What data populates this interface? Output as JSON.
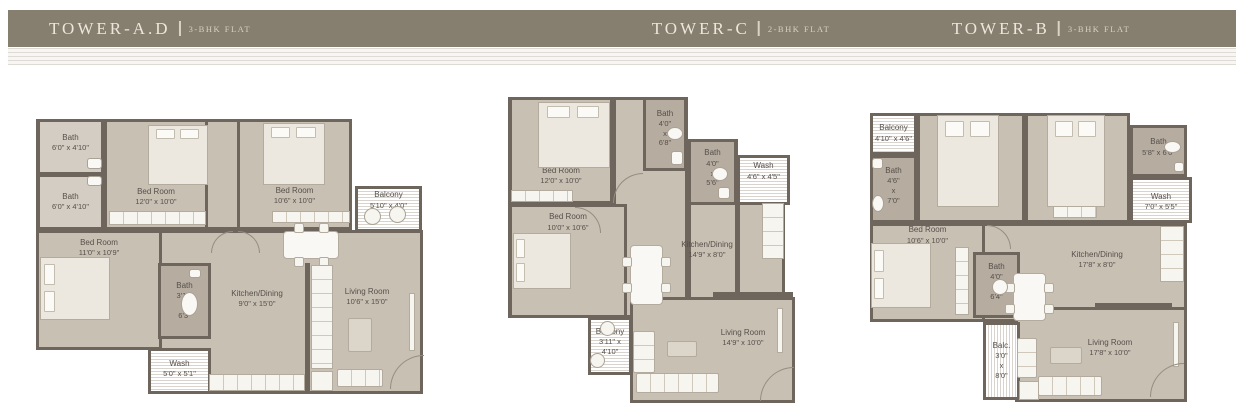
{
  "colors": {
    "wall": "#6E665D",
    "floor": "#C9C0B4",
    "bath": "#B7ACA0",
    "ink": "#55504A",
    "hatchline": "#D8D4CD",
    "bar": "#867E6F",
    "bartext": "#ECE7DA"
  },
  "header": {
    "towers": [
      {
        "name": "TOWER-A.D",
        "type": "3-BHK FLAT"
      },
      {
        "name": "TOWER-C",
        "type": "2-BHK FLAT"
      },
      {
        "name": "TOWER-B",
        "type": "3-BHK FLAT"
      }
    ]
  },
  "plans": [
    {
      "id": "tower-ad",
      "x": 35,
      "y": 112,
      "w": 395,
      "h": 286,
      "bases": [
        {
          "x": 1,
          "y": 7,
          "w": 316,
          "h": 111
        },
        {
          "x": 1,
          "y": 118,
          "w": 126,
          "h": 120
        },
        {
          "x": 113,
          "y": 118,
          "w": 275,
          "h": 164
        }
      ],
      "rooms": [
        {
          "id": "bath-1",
          "t": "bath",
          "x": 2,
          "y": 7,
          "w": 67,
          "h": 56,
          "fc": "#D4CDC3",
          "label": [
            "Bath",
            "6'0\" x 4'10\""
          ],
          "ly": 42
        },
        {
          "id": "bath-2",
          "t": "bath",
          "x": 2,
          "y": 62,
          "w": 67,
          "h": 56,
          "fc": "#D4CDC3",
          "label": [
            "Bath",
            "6'0\" x 4'10\""
          ],
          "ly": 50
        },
        {
          "id": "bedroom-1",
          "t": "room",
          "x": 69,
          "y": 7,
          "w": 104,
          "h": 111,
          "label": [
            "Bed Room",
            "12'0\" x 10'0\""
          ],
          "ly": 71
        },
        {
          "id": "bedroom-2",
          "t": "room",
          "x": 202,
          "y": 7,
          "w": 115,
          "h": 111,
          "label": [
            "Bed Room",
            "10'6\" x 10'0\""
          ],
          "ly": 70
        },
        {
          "id": "balcony",
          "t": "hatch",
          "x": 320,
          "y": 74,
          "w": 67,
          "h": 46,
          "label": [
            "Balcony",
            "5'10\" x 4'0\""
          ],
          "ly": 28
        },
        {
          "id": "bedroom-3",
          "t": "room",
          "x": 1,
          "y": 118,
          "w": 126,
          "h": 120,
          "label": [
            "Bed Room",
            "11'0\" x 10'9\""
          ],
          "ly": 13
        },
        {
          "id": "bath-3",
          "t": "bath",
          "x": 123,
          "y": 151,
          "w": 53,
          "h": 76,
          "label": [
            "Bath",
            "3'11\"",
            "x",
            "6'3\""
          ],
          "ly": 50
        },
        {
          "id": "wash",
          "t": "hatch",
          "x": 113,
          "y": 236,
          "w": 63,
          "h": 46,
          "label": [
            "Wash",
            "5'0\" x 5'1\""
          ],
          "ly": 45
        },
        {
          "id": "kitchen-dining",
          "t": "label",
          "x": 182,
          "y": 170,
          "w": 80,
          "h": 34,
          "label": [
            "Kitchen/Dining",
            "9'0\" x 15'0\""
          ],
          "ly": 50
        },
        {
          "id": "living-room",
          "t": "label",
          "x": 297,
          "y": 170,
          "w": 70,
          "h": 30,
          "label": [
            "Living Room",
            "10'6\" x 15'0\""
          ],
          "ly": 50
        }
      ],
      "furniture": [
        {
          "t": "wall",
          "n": "partition-wall",
          "x": 270,
          "y": 151,
          "w": 5,
          "h": 131
        },
        {
          "t": "bed",
          "n": "bed",
          "x": 113,
          "y": 13,
          "w": 60,
          "h": 60,
          "dir": "n"
        },
        {
          "t": "bed",
          "n": "bed",
          "x": 228,
          "y": 11,
          "w": 62,
          "h": 62,
          "dir": "n"
        },
        {
          "t": "bed",
          "n": "bed",
          "x": 5,
          "y": 145,
          "w": 70,
          "h": 63,
          "dir": "w"
        },
        {
          "t": "rect",
          "n": "wardrobe",
          "x": 74,
          "y": 99,
          "w": 97,
          "h": 14,
          "lines": "v"
        },
        {
          "t": "rect",
          "n": "wardrobe",
          "x": 237,
          "y": 99,
          "w": 78,
          "h": 12,
          "lines": "v"
        },
        {
          "t": "circle",
          "n": "balcony-chair",
          "x": 329,
          "y": 96,
          "w": 17,
          "h": 17
        },
        {
          "t": "circle",
          "n": "balcony-chair",
          "x": 354,
          "y": 94,
          "w": 17,
          "h": 17
        },
        {
          "t": "table",
          "n": "dining-table",
          "x": 248,
          "y": 119,
          "w": 56,
          "h": 28
        },
        {
          "t": "rect",
          "n": "kitchen-counter",
          "x": 174,
          "y": 262,
          "w": 96,
          "h": 17,
          "lines": "v"
        },
        {
          "t": "rect",
          "n": "kitchen-counter",
          "x": 276,
          "y": 153,
          "w": 22,
          "h": 104,
          "lines": "h"
        },
        {
          "t": "rect",
          "n": "sink-unit",
          "x": 276,
          "y": 259,
          "w": 22,
          "h": 20
        },
        {
          "t": "sofa",
          "n": "sofa",
          "x": 302,
          "y": 257,
          "w": 46,
          "h": 18,
          "lines": "v"
        },
        {
          "t": "rug",
          "n": "rug",
          "x": 313,
          "y": 206,
          "w": 24,
          "h": 34
        },
        {
          "t": "rect",
          "n": "tv-unit",
          "x": 374,
          "y": 181,
          "w": 6,
          "h": 58
        },
        {
          "t": "sink",
          "n": "wash-basin",
          "x": 52,
          "y": 46,
          "w": 15,
          "h": 11
        },
        {
          "t": "sink",
          "n": "wash-basin",
          "x": 52,
          "y": 64,
          "w": 15,
          "h": 10
        },
        {
          "t": "wc",
          "n": "toilet",
          "x": 146,
          "y": 180,
          "w": 17,
          "h": 24
        },
        {
          "t": "sink",
          "n": "wash-basin",
          "x": 154,
          "y": 157,
          "w": 12,
          "h": 9
        },
        {
          "t": "arc",
          "n": "door-arc",
          "x": 355,
          "y": 243,
          "w": 34,
          "h": 34,
          "q": "tl"
        },
        {
          "t": "arc",
          "n": "door-arc",
          "x": 176,
          "y": 119,
          "w": 22,
          "h": 22,
          "q": "tl"
        },
        {
          "t": "arc",
          "n": "door-arc",
          "x": 203,
          "y": 119,
          "w": 22,
          "h": 22,
          "q": "tr"
        }
      ]
    },
    {
      "id": "tower-c",
      "x": 505,
      "y": 95,
      "w": 298,
      "h": 310,
      "bases": [
        {
          "x": 3,
          "y": 2,
          "w": 120,
          "h": 221
        },
        {
          "x": 108,
          "y": 2,
          "w": 75,
          "h": 221
        },
        {
          "x": 183,
          "y": 44,
          "w": 50,
          "h": 179
        },
        {
          "x": 232,
          "y": 60,
          "w": 48,
          "h": 163
        },
        {
          "x": 125,
          "y": 202,
          "w": 165,
          "h": 106
        }
      ],
      "rooms": [
        {
          "id": "bedroom-1",
          "t": "room",
          "x": 4,
          "y": 2,
          "w": 104,
          "h": 107,
          "label": [
            "Bed Room",
            "12'0\" x 10'0\""
          ],
          "ly": 75
        },
        {
          "id": "bath-1",
          "t": "bath",
          "x": 138,
          "y": 2,
          "w": 44,
          "h": 74,
          "label": [
            "Bath",
            "4'0\"",
            "x",
            "6'8\""
          ],
          "ly": 42
        },
        {
          "id": "bath-2",
          "t": "bath",
          "x": 183,
          "y": 44,
          "w": 49,
          "h": 66,
          "label": [
            "Bath",
            "4'0\"",
            "x",
            "5'6\""
          ],
          "ly": 44
        },
        {
          "id": "wash",
          "t": "hatch",
          "x": 232,
          "y": 60,
          "w": 53,
          "h": 50,
          "label": [
            "Wash",
            "4'6\" x 4'5\""
          ],
          "ly": 30
        },
        {
          "id": "bedroom-2",
          "t": "room",
          "x": 4,
          "y": 109,
          "w": 118,
          "h": 114,
          "label": [
            "Bed Room",
            "10'0\" x 10'6\""
          ],
          "ly": 14
        },
        {
          "id": "kitchen-dining",
          "t": "label",
          "x": 162,
          "y": 140,
          "w": 80,
          "h": 30,
          "label": [
            "Kitchen/Dining",
            "14'9\" x 8'0\""
          ],
          "ly": 50
        },
        {
          "id": "balcony",
          "t": "hatch",
          "x": 83,
          "y": 222,
          "w": 44,
          "h": 58,
          "label": [
            "Balcony",
            "3'11\" x",
            "4'10\""
          ],
          "ly": 42
        },
        {
          "id": "living-room",
          "t": "label",
          "x": 203,
          "y": 228,
          "w": 70,
          "h": 30,
          "label": [
            "Living Room",
            "14'9\" x 10'0\""
          ],
          "ly": 50
        }
      ],
      "furniture": [
        {
          "t": "wall",
          "n": "partition-wall",
          "x": 208,
          "y": 197,
          "w": 80,
          "h": 6
        },
        {
          "t": "bed",
          "n": "bed",
          "x": 33,
          "y": 7,
          "w": 72,
          "h": 66,
          "dir": "n"
        },
        {
          "t": "rect",
          "n": "wardrobe",
          "x": 6,
          "y": 95,
          "w": 62,
          "h": 12,
          "lines": "v"
        },
        {
          "t": "bed",
          "n": "bed",
          "x": 8,
          "y": 138,
          "w": 58,
          "h": 56,
          "dir": "w"
        },
        {
          "t": "table",
          "n": "dining-table",
          "x": 125,
          "y": 150,
          "w": 33,
          "h": 60
        },
        {
          "t": "rect",
          "n": "kitchen-counter",
          "x": 257,
          "y": 108,
          "w": 22,
          "h": 56,
          "lines": "h"
        },
        {
          "t": "circle",
          "n": "balcony-chair",
          "x": 95,
          "y": 226,
          "w": 15,
          "h": 15
        },
        {
          "t": "circle",
          "n": "balcony-chair",
          "x": 85,
          "y": 258,
          "w": 15,
          "h": 15
        },
        {
          "t": "sofa",
          "n": "sofa",
          "x": 131,
          "y": 278,
          "w": 83,
          "h": 20,
          "lines": "v"
        },
        {
          "t": "sofa",
          "n": "armchair",
          "x": 128,
          "y": 236,
          "w": 22,
          "h": 42,
          "lines": "h"
        },
        {
          "t": "rug",
          "n": "rug",
          "x": 162,
          "y": 246,
          "w": 30,
          "h": 16
        },
        {
          "t": "rect",
          "n": "tv-unit",
          "x": 272,
          "y": 213,
          "w": 6,
          "h": 45
        },
        {
          "t": "wc",
          "n": "toilet",
          "x": 162,
          "y": 32,
          "w": 16,
          "h": 13
        },
        {
          "t": "sink",
          "n": "wash-basin",
          "x": 166,
          "y": 56,
          "w": 12,
          "h": 14
        },
        {
          "t": "wc",
          "n": "toilet",
          "x": 207,
          "y": 72,
          "w": 16,
          "h": 14
        },
        {
          "t": "sink",
          "n": "wash-basin",
          "x": 213,
          "y": 92,
          "w": 12,
          "h": 12
        },
        {
          "t": "arc",
          "n": "door-arc",
          "x": 108,
          "y": 78,
          "w": 30,
          "h": 30,
          "q": "tl"
        },
        {
          "t": "arc",
          "n": "door-arc",
          "x": 255,
          "y": 272,
          "w": 34,
          "h": 34,
          "q": "tl"
        },
        {
          "t": "arc",
          "n": "door-arc",
          "x": 70,
          "y": 112,
          "w": 26,
          "h": 26,
          "q": "tr"
        }
      ]
    },
    {
      "id": "tower-b",
      "x": 870,
      "y": 105,
      "w": 332,
      "h": 300,
      "bases": [
        {
          "x": 0,
          "y": 8,
          "w": 260,
          "h": 110
        },
        {
          "x": 260,
          "y": 20,
          "w": 57,
          "h": 98
        },
        {
          "x": 0,
          "y": 118,
          "w": 317,
          "h": 99
        },
        {
          "x": 145,
          "y": 202,
          "w": 172,
          "h": 95
        }
      ],
      "rooms": [
        {
          "id": "balcony-1",
          "t": "hatch",
          "x": 0,
          "y": 8,
          "w": 47,
          "h": 42,
          "label": [
            "Balcony",
            "4'10\" x 4'6\""
          ],
          "ly": 48
        },
        {
          "id": "bath-1",
          "t": "bath",
          "x": 0,
          "y": 50,
          "w": 47,
          "h": 68,
          "label": [
            "Bath",
            "4'6\"",
            "x",
            "7'0\""
          ],
          "ly": 45
        },
        {
          "id": "bedroom-1",
          "t": "room",
          "x": 47,
          "y": 8,
          "w": 108,
          "h": 110,
          "label": [
            "Bed Room",
            "11'0\" x 11'6\""
          ],
          "ly": 68
        },
        {
          "id": "bedroom-2",
          "t": "room",
          "x": 155,
          "y": 8,
          "w": 105,
          "h": 110,
          "label": [
            "Bed Room",
            "11'0\" x 11'6\""
          ],
          "ly": 68
        },
        {
          "id": "bath-2",
          "t": "bath",
          "x": 260,
          "y": 20,
          "w": 57,
          "h": 52,
          "label": [
            "Bath",
            "5'8\" x 6'6\""
          ],
          "ly": 42
        },
        {
          "id": "wash",
          "t": "hatch",
          "x": 260,
          "y": 72,
          "w": 62,
          "h": 46,
          "label": [
            "Wash",
            "7'0\" x 5'5\""
          ],
          "ly": 55
        },
        {
          "id": "bedroom-3",
          "t": "room",
          "x": 0,
          "y": 118,
          "w": 115,
          "h": 99,
          "label": [
            "Bed Room",
            "10'6\" x 10'0\""
          ],
          "ly": 10
        },
        {
          "id": "bath-3",
          "t": "bath",
          "x": 103,
          "y": 147,
          "w": 47,
          "h": 66,
          "label": [
            "Bath",
            "4'0\"",
            "x",
            "6'4\""
          ],
          "ly": 45
        },
        {
          "id": "balcony-2",
          "t": "hatch-v",
          "x": 113,
          "y": 217,
          "w": 37,
          "h": 78,
          "label": [
            "Balc.",
            "3'0\"",
            "x",
            "8'0\""
          ],
          "ly": 50
        },
        {
          "id": "kitchen-dining",
          "t": "label",
          "x": 187,
          "y": 140,
          "w": 80,
          "h": 30,
          "label": [
            "Kitchen/Dining",
            "17'8\" x 8'0\""
          ],
          "ly": 50
        },
        {
          "id": "living-room",
          "t": "label",
          "x": 200,
          "y": 228,
          "w": 80,
          "h": 30,
          "label": [
            "Living Room",
            "17'8\" x 10'0\""
          ],
          "ly": 50
        }
      ],
      "furniture": [
        {
          "t": "wall",
          "n": "partition-wall",
          "x": 225,
          "y": 198,
          "w": 77,
          "h": 6
        },
        {
          "t": "bed",
          "n": "bed",
          "x": 67,
          "y": 10,
          "w": 62,
          "h": 92,
          "dir": "n"
        },
        {
          "t": "bed",
          "n": "bed",
          "x": 177,
          "y": 10,
          "w": 58,
          "h": 92,
          "dir": "n"
        },
        {
          "t": "rect",
          "n": "wardrobe",
          "x": 183,
          "y": 101,
          "w": 44,
          "h": 12,
          "lines": "v"
        },
        {
          "t": "bed",
          "n": "bed",
          "x": 1,
          "y": 138,
          "w": 60,
          "h": 65,
          "dir": "w"
        },
        {
          "t": "rect",
          "n": "wardrobe",
          "x": 85,
          "y": 142,
          "w": 14,
          "h": 68,
          "lines": "h"
        },
        {
          "t": "table",
          "n": "dining-table",
          "x": 143,
          "y": 168,
          "w": 33,
          "h": 48
        },
        {
          "t": "rect",
          "n": "kitchen-counter",
          "x": 290,
          "y": 121,
          "w": 24,
          "h": 56,
          "lines": "h"
        },
        {
          "t": "sofa",
          "n": "sofa",
          "x": 168,
          "y": 271,
          "w": 64,
          "h": 20,
          "lines": "v"
        },
        {
          "t": "sofa",
          "n": "armchair",
          "x": 147,
          "y": 233,
          "w": 20,
          "h": 40,
          "lines": "h"
        },
        {
          "t": "rug",
          "n": "rug",
          "x": 180,
          "y": 242,
          "w": 32,
          "h": 17
        },
        {
          "t": "rect",
          "n": "tv-unit",
          "x": 303,
          "y": 217,
          "w": 6,
          "h": 45
        },
        {
          "t": "rect",
          "n": "sink-unit",
          "x": 149,
          "y": 276,
          "w": 20,
          "h": 19
        },
        {
          "t": "sink",
          "n": "wash-basin",
          "x": 2,
          "y": 53,
          "w": 11,
          "h": 11
        },
        {
          "t": "wc",
          "n": "toilet",
          "x": 2,
          "y": 90,
          "w": 12,
          "h": 17
        },
        {
          "t": "wc",
          "n": "toilet",
          "x": 294,
          "y": 36,
          "w": 17,
          "h": 12
        },
        {
          "t": "sink",
          "n": "wash-basin",
          "x": 304,
          "y": 57,
          "w": 10,
          "h": 10
        },
        {
          "t": "wc",
          "n": "toilet",
          "x": 122,
          "y": 174,
          "w": 16,
          "h": 16
        },
        {
          "t": "arc",
          "n": "door-arc",
          "x": 280,
          "y": 258,
          "w": 34,
          "h": 34,
          "q": "tl"
        },
        {
          "t": "arc",
          "n": "door-arc",
          "x": 117,
          "y": 120,
          "w": 24,
          "h": 24,
          "q": "tr"
        }
      ]
    }
  ]
}
